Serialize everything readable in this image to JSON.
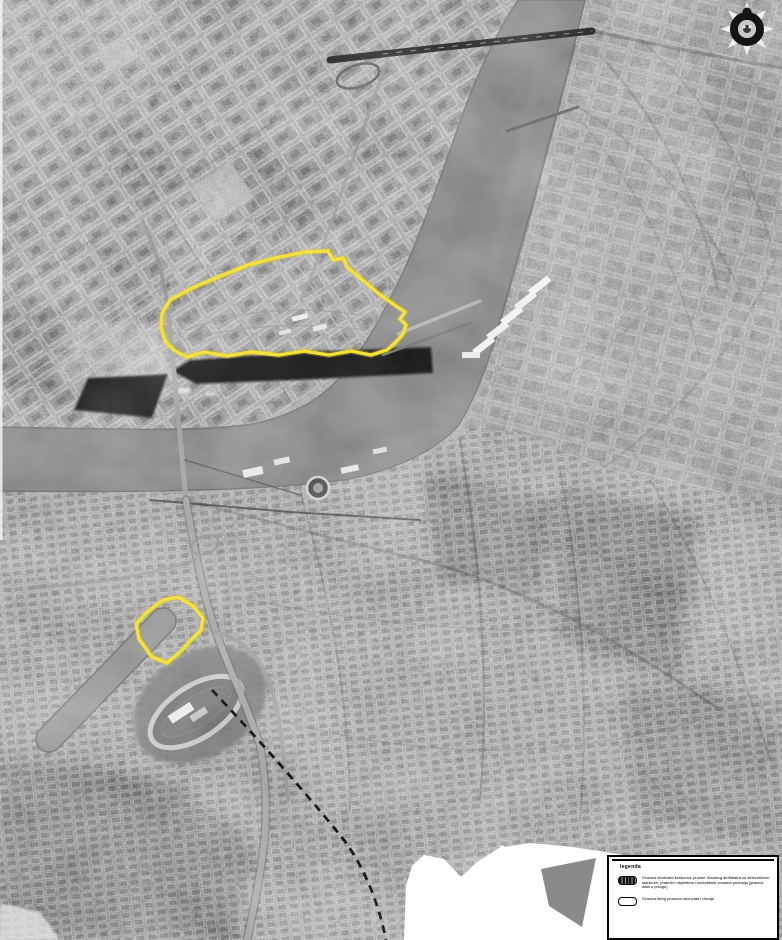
{
  "document": {
    "kind": "grayscale aerial orthophoto of a city with river bend",
    "annotation_color": "#f2de3a"
  },
  "legend": {
    "title": "legenda",
    "items": [
      {
        "symbol": "hatched-boundary-swatch",
        "label": "Granica obuhvata konkursa: prostor Savskog amfiteatra sa železničkom stanicom, pratećim objektima i kontaktnim zonama priobalja (granica data u prilogu)"
      },
      {
        "symbol": "outline-boundary-swatch",
        "label": "Granica šireg prostora obuhvata i uticaja"
      }
    ]
  },
  "overlays": {
    "large_site": {
      "name": "large-site-boundary",
      "points": "162,313 170,300 192,288 218,277 248,265 275,258 305,252 328,251 333,260 343,258 347,267 361,279 379,294 396,306 405,312 400,319 406,325 403,334 396,342 387,350 371,355 351,351 329,355 304,351 279,355 251,352 227,356 204,352 187,357 175,351 165,341 161,327"
    },
    "small_site": {
      "name": "small-site-boundary",
      "points": "178,597 163,600 147,612 136,624 139,639 152,657 167,663 180,652 190,641 201,630 203,618 193,606"
    }
  },
  "emblem": {
    "name": "sunburst-compass-emblem"
  },
  "colors": {
    "land": "#767676",
    "river": "#7c7c7c",
    "dock_basin": "#141414",
    "blank_area": "#ffffff",
    "boundary_yellow": "#f3e13d"
  }
}
